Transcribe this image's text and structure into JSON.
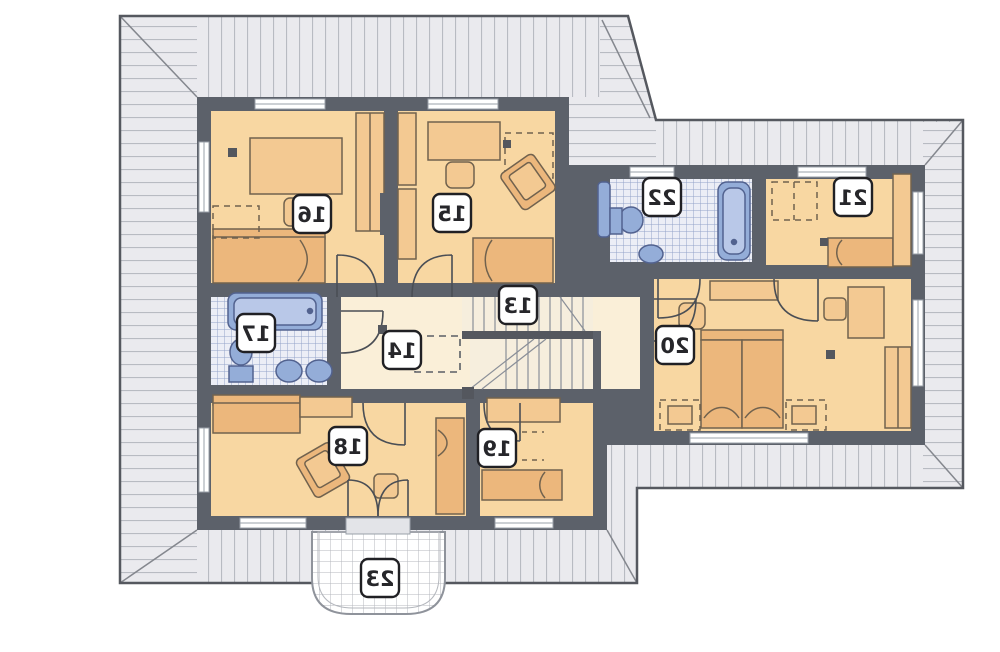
{
  "plan": {
    "type": "floor-plan",
    "labels_mirrored": true,
    "rooms": [
      {
        "number": "13",
        "kind": "staircase"
      },
      {
        "number": "14",
        "kind": "hallway"
      },
      {
        "number": "15",
        "kind": "bedroom"
      },
      {
        "number": "16",
        "kind": "bedroom"
      },
      {
        "number": "17",
        "kind": "bathroom"
      },
      {
        "number": "18",
        "kind": "bedroom"
      },
      {
        "number": "19",
        "kind": "bedroom"
      },
      {
        "number": "20",
        "kind": "bedroom"
      },
      {
        "number": "21",
        "kind": "bedroom"
      },
      {
        "number": "22",
        "kind": "bathroom"
      },
      {
        "number": "23",
        "kind": "balcony"
      }
    ],
    "colors": {
      "wall": "#5c616a",
      "room_fill": "#f8d7a2",
      "hall_fill": "#faefd8",
      "stair_fill": "#f6eedd",
      "roof_fill": "#eaeaee",
      "roof_hatch": "#b8bbc2",
      "roof_outline": "#55585f",
      "tile_bg": "#eceef6",
      "tile_line": "#94a4c9",
      "fixture_blue": "#94add8",
      "fixture_blue_dark": "#52628f",
      "furniture_light": "#f3c992",
      "furniture_dark": "#ecb77c",
      "furniture_stroke": "#71624e",
      "label_border": "#202024",
      "label_text": "#26262a"
    }
  }
}
